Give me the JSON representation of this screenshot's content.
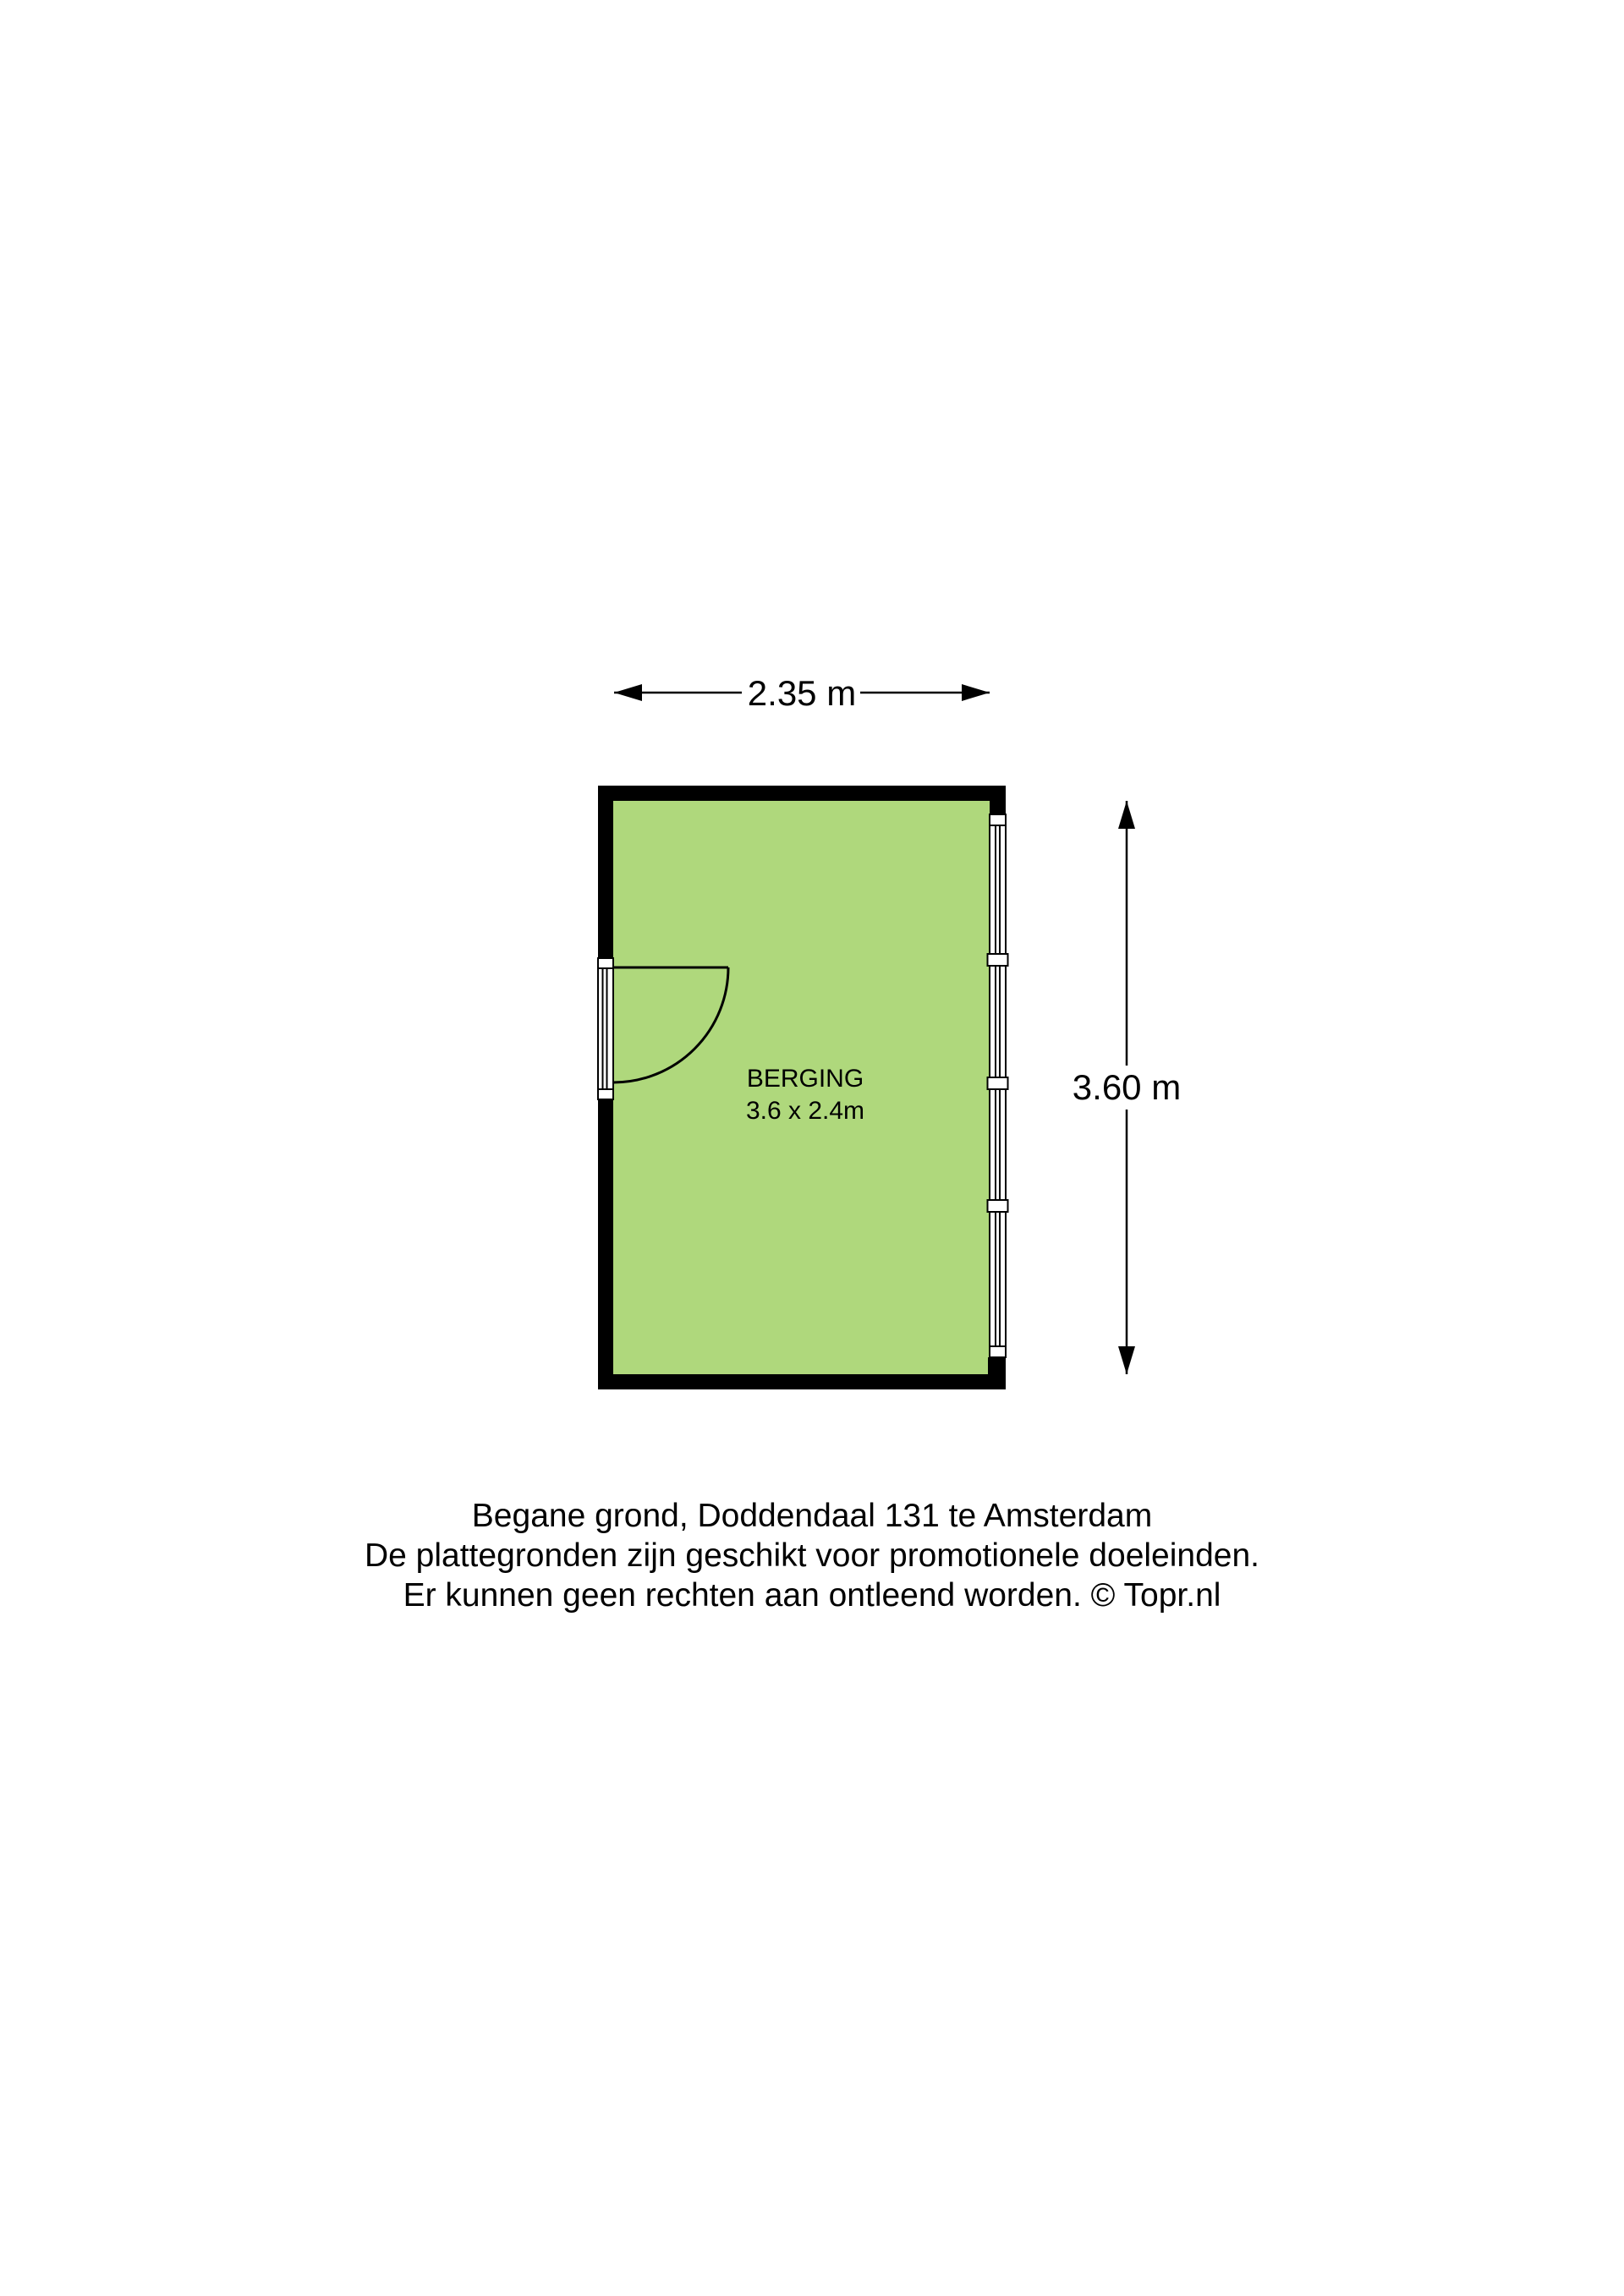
{
  "floorplan": {
    "room": {
      "name": "BERGING",
      "size_label": "3.6 x 2.4m"
    },
    "dimensions": {
      "width_label": "2.35 m",
      "height_label": "3.60 m"
    },
    "colors": {
      "floor_fill": "#afd87c",
      "wall": "#000000",
      "background": "#ffffff"
    }
  },
  "caption": {
    "line1": "Begane grond, Doddendaal 131 te Amsterdam",
    "line2": "De plattegronden zijn geschikt voor promotionele doeleinden.",
    "line3": "Er kunnen geen rechten aan ontleend worden. © Topr.nl"
  }
}
